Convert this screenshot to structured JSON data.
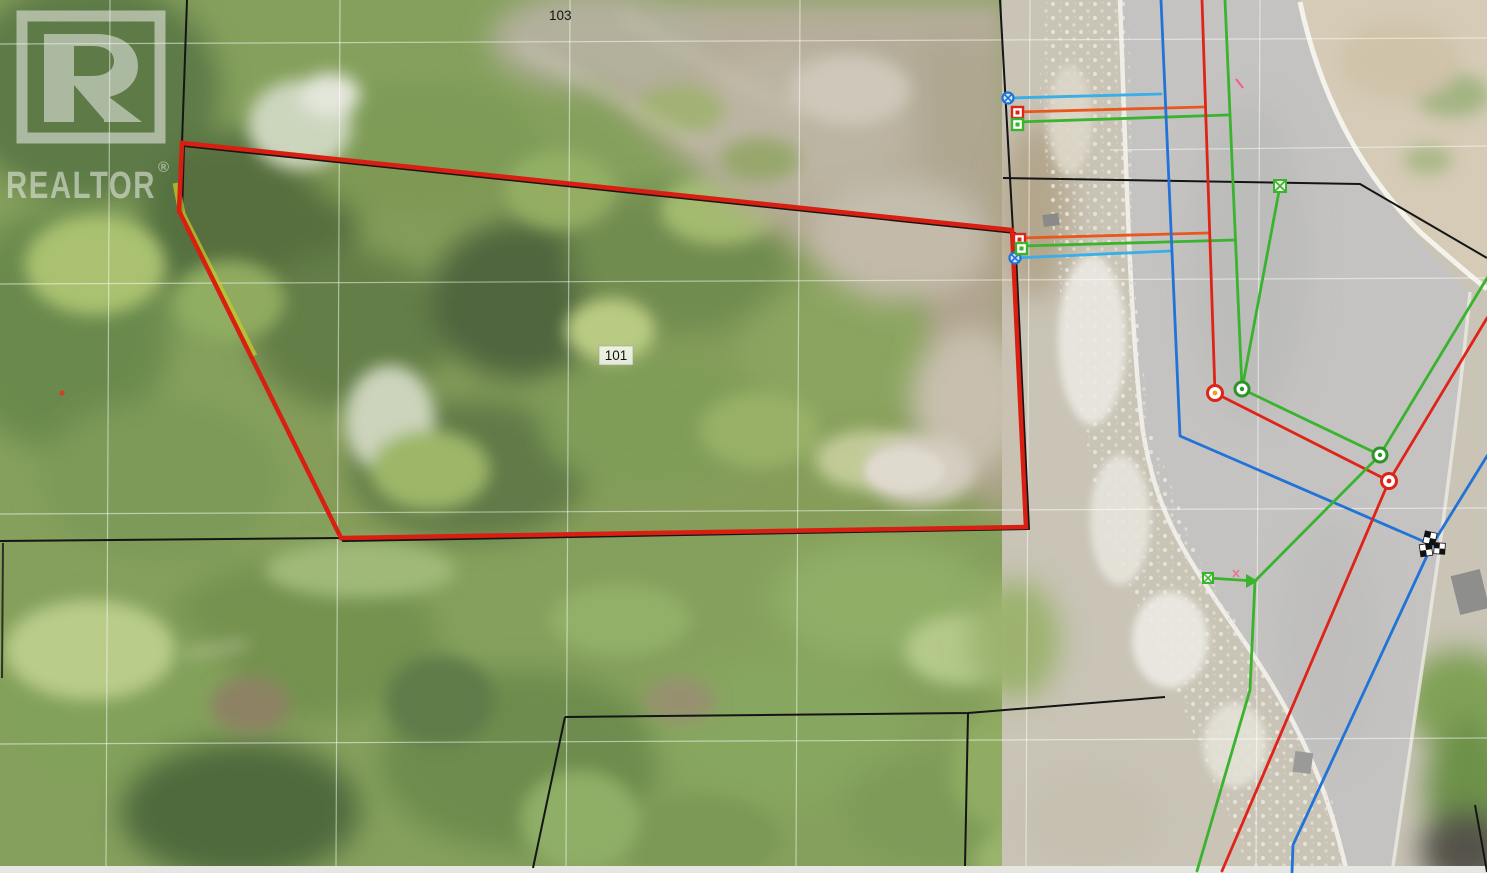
{
  "page": {
    "type": "aerial-parcel-map-photo",
    "description": "aerial ortho photo with cadastral lot lines, highlighted lot outline and utility service lines"
  },
  "watermark": {
    "brand": "REALTOR",
    "registered": "®"
  },
  "parcel_labels": [
    {
      "label": "103"
    },
    {
      "label": "101"
    }
  ],
  "highlighted_parcel": {
    "label": "101",
    "outline_color": "#d81f12",
    "highlight_color": "#c9ce2a"
  },
  "utility_lines": [
    {
      "name": "blue-utility-line",
      "color": "#2273d8"
    },
    {
      "name": "cyan-service-stub-line",
      "color": "#3aaee6"
    },
    {
      "name": "red-utility-line",
      "color": "#e02318"
    },
    {
      "name": "orange-service-stub-line",
      "color": "#e8571d"
    },
    {
      "name": "green-utility-line",
      "color": "#3ab32e"
    }
  ],
  "markers": [
    {
      "name": "blue-circle-x-marker",
      "color": "#2273d8",
      "count": 2
    },
    {
      "name": "red-square-marker",
      "color": "#e02318",
      "count": 2
    },
    {
      "name": "green-square-marker",
      "color": "#3ab32e",
      "count": 2
    },
    {
      "name": "red-circle-node-marker",
      "color": "#e02318",
      "count": 2
    },
    {
      "name": "green-circle-node-marker",
      "color": "#3ab32e",
      "count": 2
    },
    {
      "name": "green-x-square-marker",
      "color": "#3ab32e",
      "count": 2
    },
    {
      "name": "green-arrow-junction-marker",
      "color": "#3ab32e",
      "count": 1
    },
    {
      "name": "checkered-flag-end-marker",
      "color": "#000000",
      "count": 1
    },
    {
      "name": "pink-tick-mark",
      "color": "#f2608a",
      "count": 2
    },
    {
      "name": "red-dot-mark",
      "color": "#d2401f",
      "count": 1
    }
  ],
  "colors": {
    "parcel_red": "#d81f12",
    "highlight_yellow": "#c9ce2a",
    "utility_blue": "#2273d8",
    "utility_cyan": "#3aaee6",
    "utility_red": "#e02318",
    "utility_orange": "#e8571d",
    "utility_green": "#3ab32e",
    "cadastral_black": "#151515",
    "grid_white": "#ffffff",
    "label_text": "#121212",
    "watermark_white": "#f4f4f2",
    "marker_pink": "#f2608a"
  }
}
